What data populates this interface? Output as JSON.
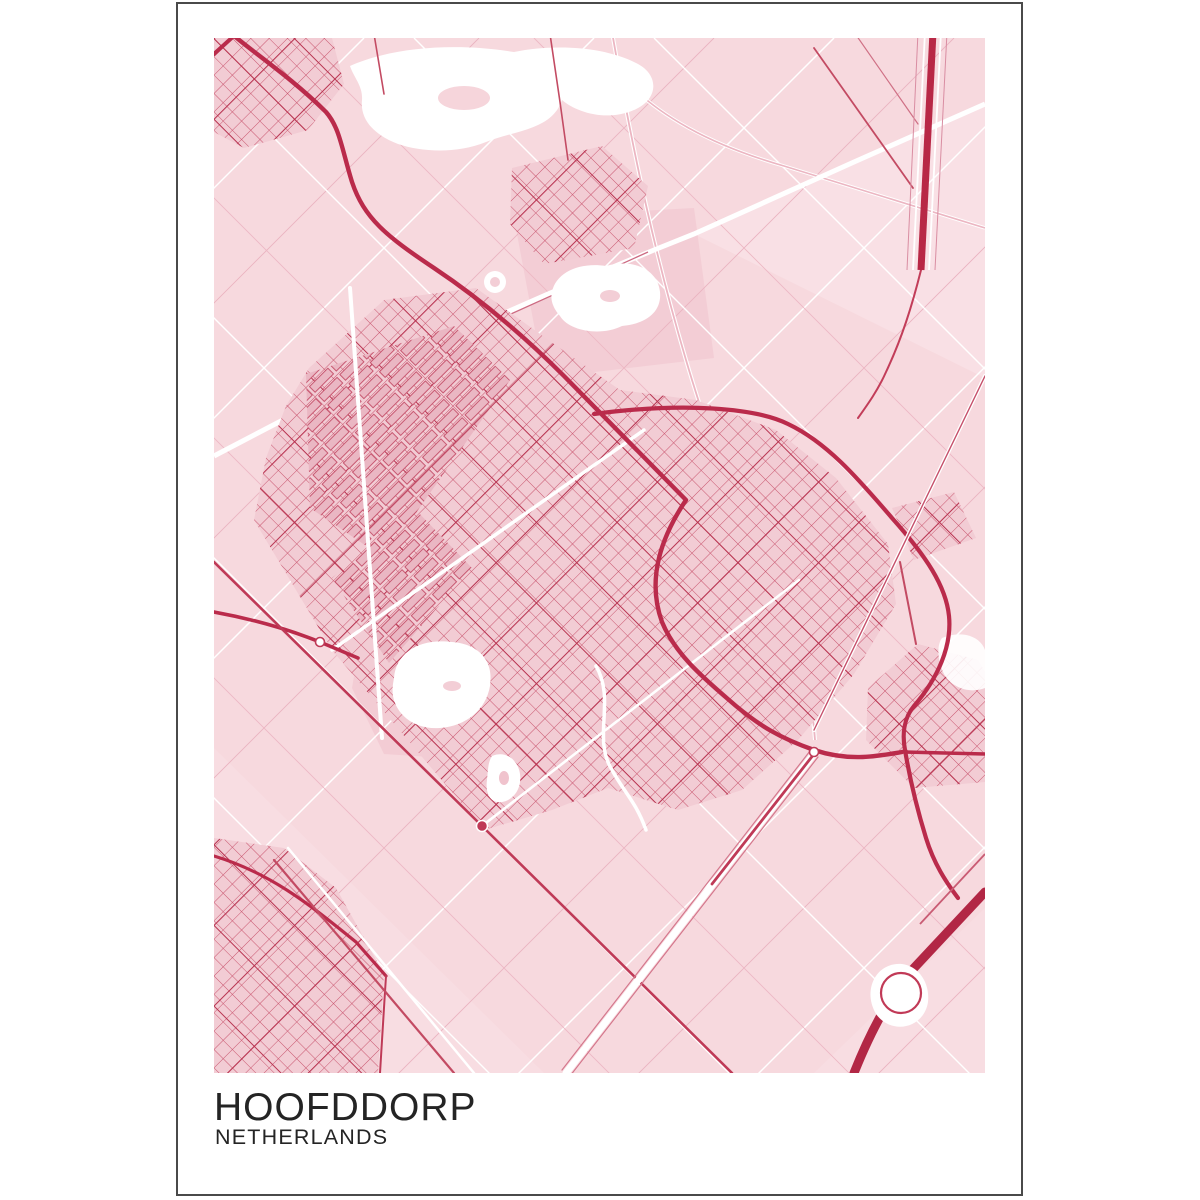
{
  "poster": {
    "title": "HOOFDDORP",
    "subtitle": "NETHERLANDS"
  },
  "palette": {
    "page_background": "#ffffff",
    "frame_line": "#4a4a4a",
    "map_background": "#f7d9de",
    "field_line_light": "#eab3c0",
    "minor_street": "#c9566f",
    "main_street": "#b83350",
    "major_road": "#ba2b4b",
    "motorway": "#b22745",
    "runway": "#b82846",
    "water": "#ffffff",
    "urban_area": "#f2ccd4",
    "title_text": "#242424"
  }
}
